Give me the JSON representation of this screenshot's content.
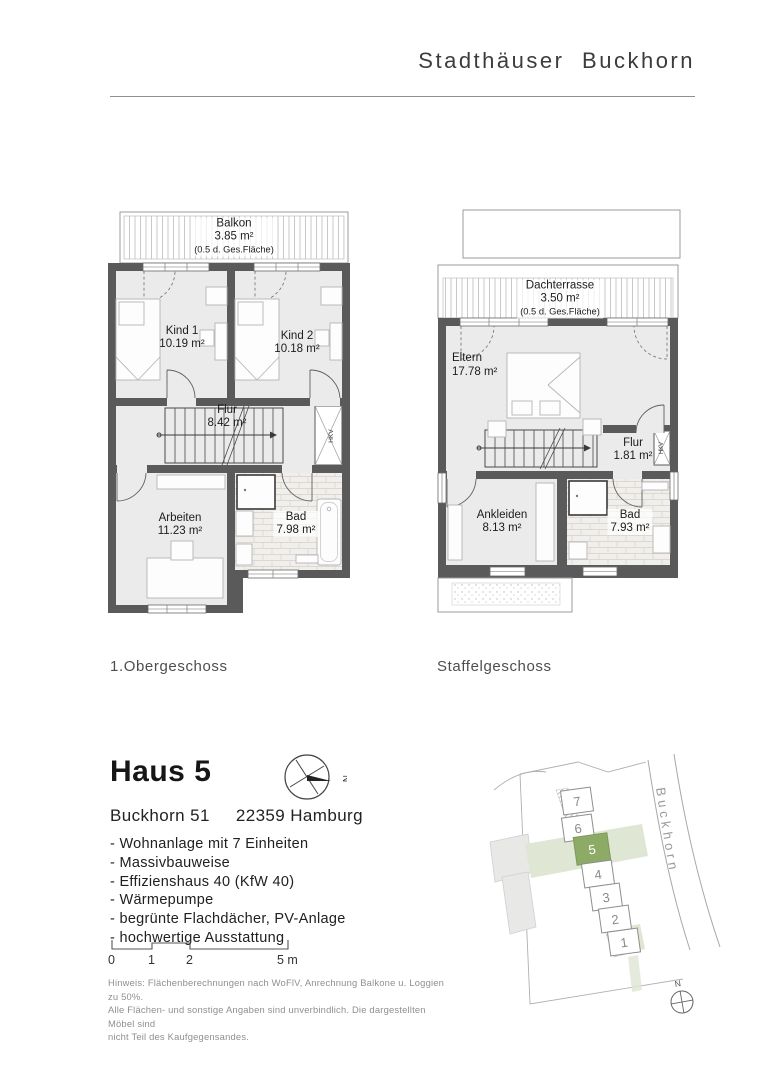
{
  "header": {
    "title": "Stadthäuser Buckhorn"
  },
  "floorplans": {
    "obergeschoss": {
      "caption": "1.Obergeschoss",
      "balkon": {
        "name": "Balkon",
        "area": "3.85 m²",
        "note": "(0.5 d. Ges.Fläche)"
      },
      "kind1": {
        "name": "Kind 1",
        "area": "10.19 m²"
      },
      "kind2": {
        "name": "Kind 2",
        "area": "10.18 m²"
      },
      "flur": {
        "name": "Flur",
        "area": "8.42 m²"
      },
      "arbeiten": {
        "name": "Arbeiten",
        "area": "11.23 m²"
      },
      "bad": {
        "name": "Bad",
        "area": "7.98 m²"
      },
      "shaft_label": "HKV"
    },
    "staffelgeschoss": {
      "caption": "Staffelgeschoss",
      "dachterrasse": {
        "name": "Dachterrasse",
        "area": "3.50 m²",
        "note": "(0.5 d. Ges.Fläche)"
      },
      "eltern": {
        "name": "Eltern",
        "area": "17.78 m²"
      },
      "flur": {
        "name": "Flur",
        "area": "1.81 m²"
      },
      "ankleiden": {
        "name": "Ankleiden",
        "area": "8.13 m²"
      },
      "bad": {
        "name": "Bad",
        "area": "7.93 m²"
      },
      "shaft_label": "HKV"
    }
  },
  "details": {
    "house_title": "Haus 5",
    "address_street": "Buckhorn 51",
    "address_city": "22359 Hamburg",
    "features": [
      "- Wohnanlage mit 7 Einheiten",
      "- Massivbauweise",
      "- Effizienshaus 40 (KfW 40)",
      "- Wärmepumpe",
      "- begrünte Flachdächer, PV-Anlage",
      "- hochwertige Ausstattung"
    ]
  },
  "scalebar": {
    "labels": [
      "0",
      "1",
      "2",
      "5 m"
    ]
  },
  "disclaimer": {
    "line1": "Hinweis:  Flächenberechnungen nach WoFlV,  Anrechnung Balkone u. Loggien zu 50%.",
    "line2": "Alle Flächen- und sonstige Angaben sind unverbindlich. Die dargestellten Möbel sind",
    "line3": "nicht Teil des Kaufgegensandes."
  },
  "compass": {
    "north_label": "N"
  },
  "sitemap": {
    "street_label": "Buckhorn",
    "north_label": "N",
    "highlight_color": "#8dab67",
    "band_color": "#dfe6d3",
    "houses": [
      {
        "number": "7",
        "highlighted": false
      },
      {
        "number": "6",
        "highlighted": false
      },
      {
        "number": "5",
        "highlighted": true
      },
      {
        "number": "4",
        "highlighted": false
      },
      {
        "number": "3",
        "highlighted": false
      },
      {
        "number": "2",
        "highlighted": false
      },
      {
        "number": "1",
        "highlighted": false
      }
    ]
  },
  "colors": {
    "wall": "#5a5a5a",
    "floor": "#ebebeb",
    "outline": "#9b9b9b"
  }
}
